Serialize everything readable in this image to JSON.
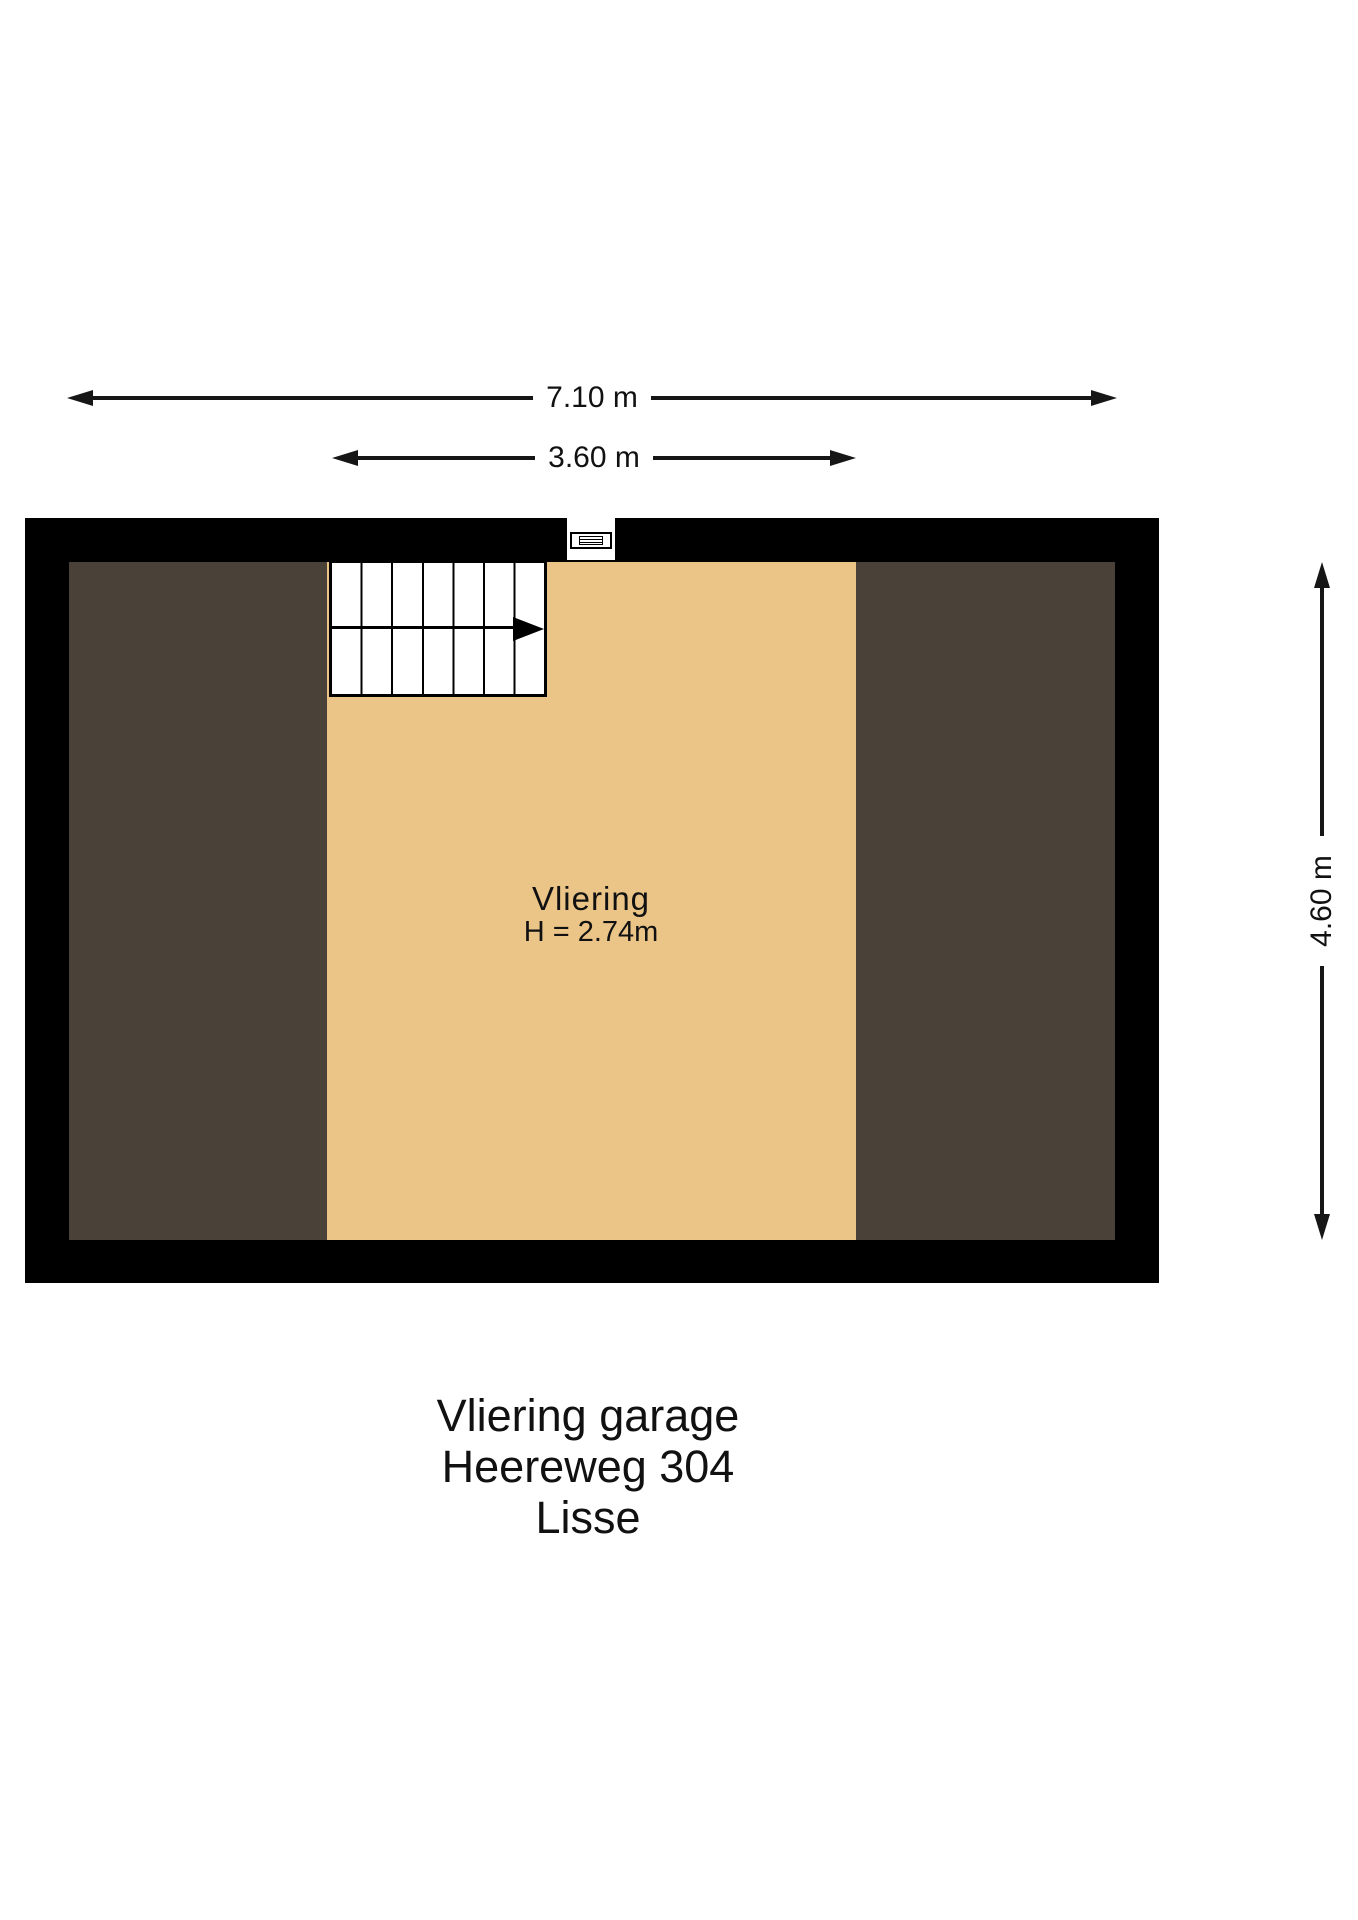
{
  "floorplan": {
    "dimensions": {
      "total_width": "7.10 m",
      "vliering_width": "3.60 m",
      "total_depth": "4.60 m"
    },
    "room": {
      "name": "Vliering",
      "ceiling_height": "H = 2.74m"
    },
    "elements": {
      "stairs": "staircase-with-direction-arrow",
      "window": "louvered-vent-window"
    },
    "colors": {
      "wall": "#000000",
      "vliering_floor": "#ebc487",
      "side_floor": "#4a4138",
      "dimension_line": "#161616",
      "background": "#ffffff"
    }
  },
  "caption": {
    "lines": [
      "Vliering garage",
      "Heereweg 304",
      "Lisse"
    ]
  }
}
